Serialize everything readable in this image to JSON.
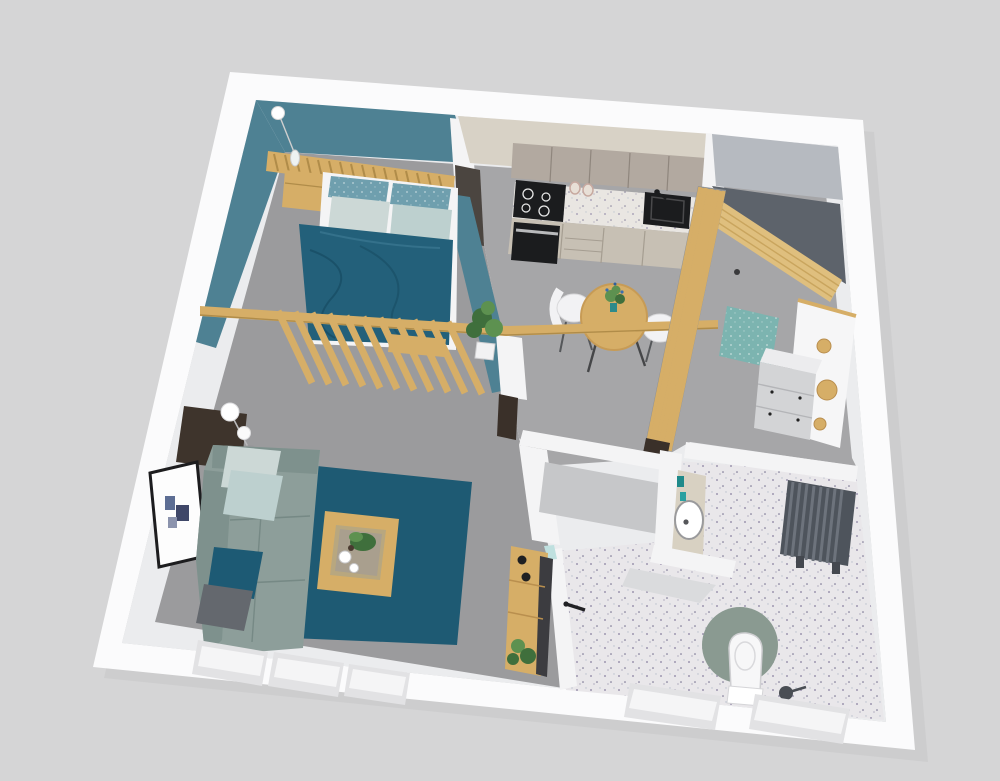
{
  "scene": {
    "type": "3d-floor-plan-render",
    "description": "isometric dollhouse view of a studio apartment",
    "width_px": 1000,
    "height_px": 781
  },
  "palette": {
    "bg": "#d5d5d6",
    "shadow": "#c6c6c8",
    "wall": "#fbfbfc",
    "wall_face": "#ebecee",
    "hall_face": "#b6bac0",
    "teal": "#4e8193",
    "carpet": "#9b9b9d",
    "floor": "#a6a6a8",
    "terrazzo": "#e9e7ea",
    "wood": "#d6ae67",
    "wood_dark": "#b08c49",
    "wood_light": "#ecd8a8",
    "duvet": "#23607a",
    "rug": "#1e5a73",
    "sofa": "#8d9e9a",
    "sofa_dark": "#7e918d",
    "pillow_light": "#ccd8d6",
    "pillow_pale": "#bdd0cf",
    "pillow_spec": "#6f9fae",
    "pillow_navy": "#1d5a74",
    "pillow_gray": "#64686e",
    "cab_cream": "#d8d2c6",
    "cab_greige": "#b2a9a0",
    "cab_lower": "#c7c0b4",
    "counter": "#e9e6e2",
    "black": "#1b1c1e",
    "steel": "#b9babc",
    "niche": "#c6c7c9",
    "radiator": "#4e545c",
    "bath_rug": "#8a9a91",
    "mat": "#7cb4b0",
    "door_wood": "#dfbf7e",
    "door_shadow": "#5d636b",
    "post": "#3a3029",
    "panel_dark": "#4b4540",
    "console": "#3e342c",
    "frame": "#1d1d1f",
    "art_navy": "#3f4768",
    "art_blue": "#5d6e94",
    "art_pale": "#8b93ad",
    "plant": "#3f6f3c",
    "plant_light": "#5d9150",
    "white": "#f4f4f5",
    "step": "#dadbdd"
  },
  "rooms": {
    "bedroom": {
      "accent_wall_color": "#4e8193",
      "objects": [
        "double-bed",
        "teal-duvet",
        "speckled-pillows",
        "plain-pillows",
        "wood-slat-headboard",
        "wood-nightstand",
        "pendant-lamp",
        "foot-bench",
        "floor-plant"
      ]
    },
    "kitchen": {
      "objects": [
        "upper-cabinets",
        "lower-cabinets",
        "induction-cooktop",
        "oven",
        "terrazzo-countertop",
        "black-sink",
        "faucet",
        "storage-jars"
      ]
    },
    "dining": {
      "objects": [
        "round-wood-table",
        "flower-vase",
        "white-shell-chair-left",
        "white-shell-chair-right",
        "overhead-wood-beam"
      ]
    },
    "entry": {
      "objects": [
        "open-wood-door",
        "vertical-slat-screen",
        "teal-doormat",
        "coat-rack-panel",
        "wood-knob-hooks",
        "white-dresser"
      ]
    },
    "bathroom": {
      "objects": [
        "terrazzo-floor",
        "round-basin-vanity",
        "teal-toiletries",
        "dark-radiator",
        "toilet",
        "sage-round-rug",
        "toilet-brush",
        "white-door-black-handle",
        "utility-niche",
        "shower-step"
      ]
    },
    "living": {
      "objects": [
        "corner-sofa",
        "scatter-pillows",
        "teal-area-rug",
        "wood-coffee-table",
        "tray-with-plant-and-cups",
        "double-globe-floor-lamp",
        "framed-abstract-art",
        "dark-console",
        "wood-ladder-shelf",
        "slat-room-divider"
      ]
    },
    "windows": [
      "living-window-1",
      "living-window-2",
      "living-window-3",
      "bathroom-window-1",
      "bathroom-window-2"
    ]
  }
}
